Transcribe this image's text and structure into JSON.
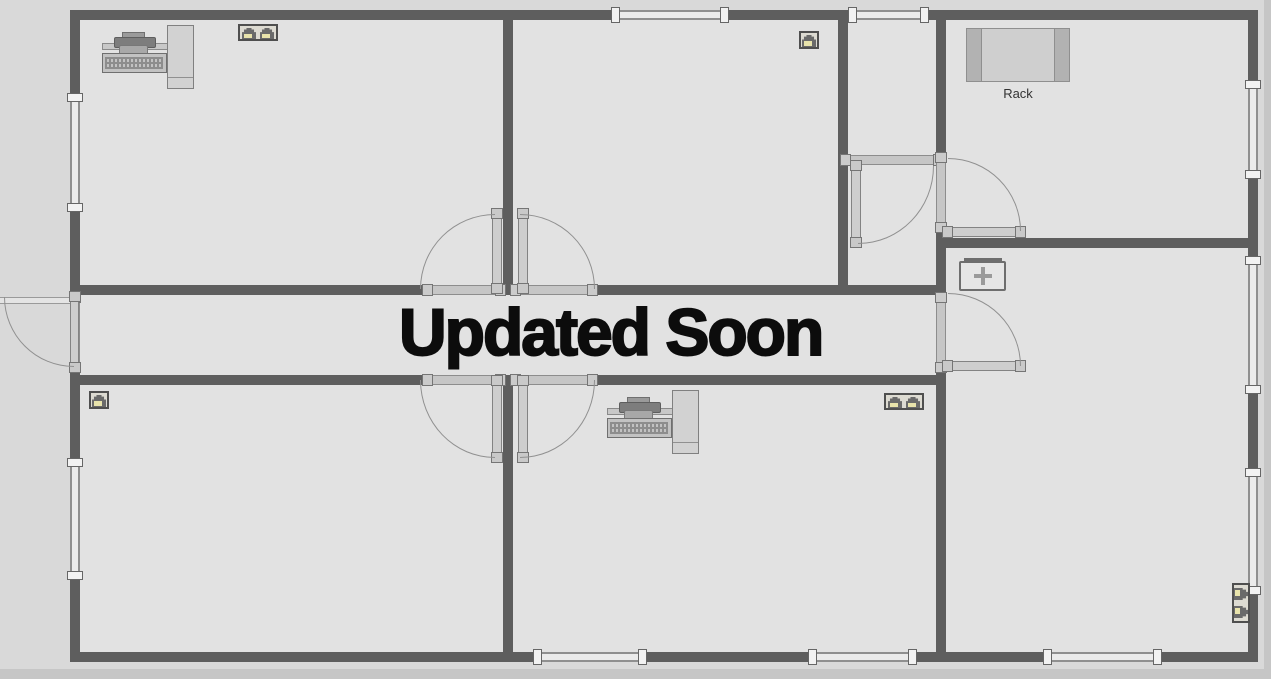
{
  "overlay_text": "Updated Soon",
  "rack_label": "Rack",
  "colors": {
    "wall": "#5e5e5e",
    "floor": "#e2e2e2",
    "outside": "#d9d9d9",
    "door_leaf": "#cecece",
    "swing_arc": "#909090",
    "window_band": "#ebebeb",
    "jack_body": "#6a6a6a",
    "jack_port": "#e8e3ab",
    "overlay_text_color": "#0c0c0c"
  },
  "icons": {
    "workstation": "computer-workstation-top-view",
    "rj45_single": "rj45-wall-outlet",
    "rj45_duplex": "rj45-duplex-wall-outlet",
    "rj45_duplex_vertical": "rj45-duplex-wall-outlet-vertical",
    "hub": "junction-box-with-cross",
    "rack": "equipment-rack-top-view"
  },
  "equipment": [
    {
      "icon": "computer-workstation",
      "location": "top-left-room"
    },
    {
      "icon": "rj45-duplex-wall-outlet",
      "location": "top-left-room"
    },
    {
      "icon": "rj45-wall-outlet",
      "location": "top-middle-room"
    },
    {
      "icon": "equipment-rack",
      "location": "top-right-room",
      "label": "Rack"
    },
    {
      "icon": "junction-box",
      "location": "right-room"
    },
    {
      "icon": "rj45-wall-outlet",
      "location": "bottom-left-room"
    },
    {
      "icon": "computer-workstation",
      "location": "bottom-middle-room"
    },
    {
      "icon": "rj45-duplex-wall-outlet",
      "location": "bottom-middle-room"
    },
    {
      "icon": "rj45-duplex-wall-outlet-vertical",
      "location": "bottom-right-room"
    }
  ]
}
